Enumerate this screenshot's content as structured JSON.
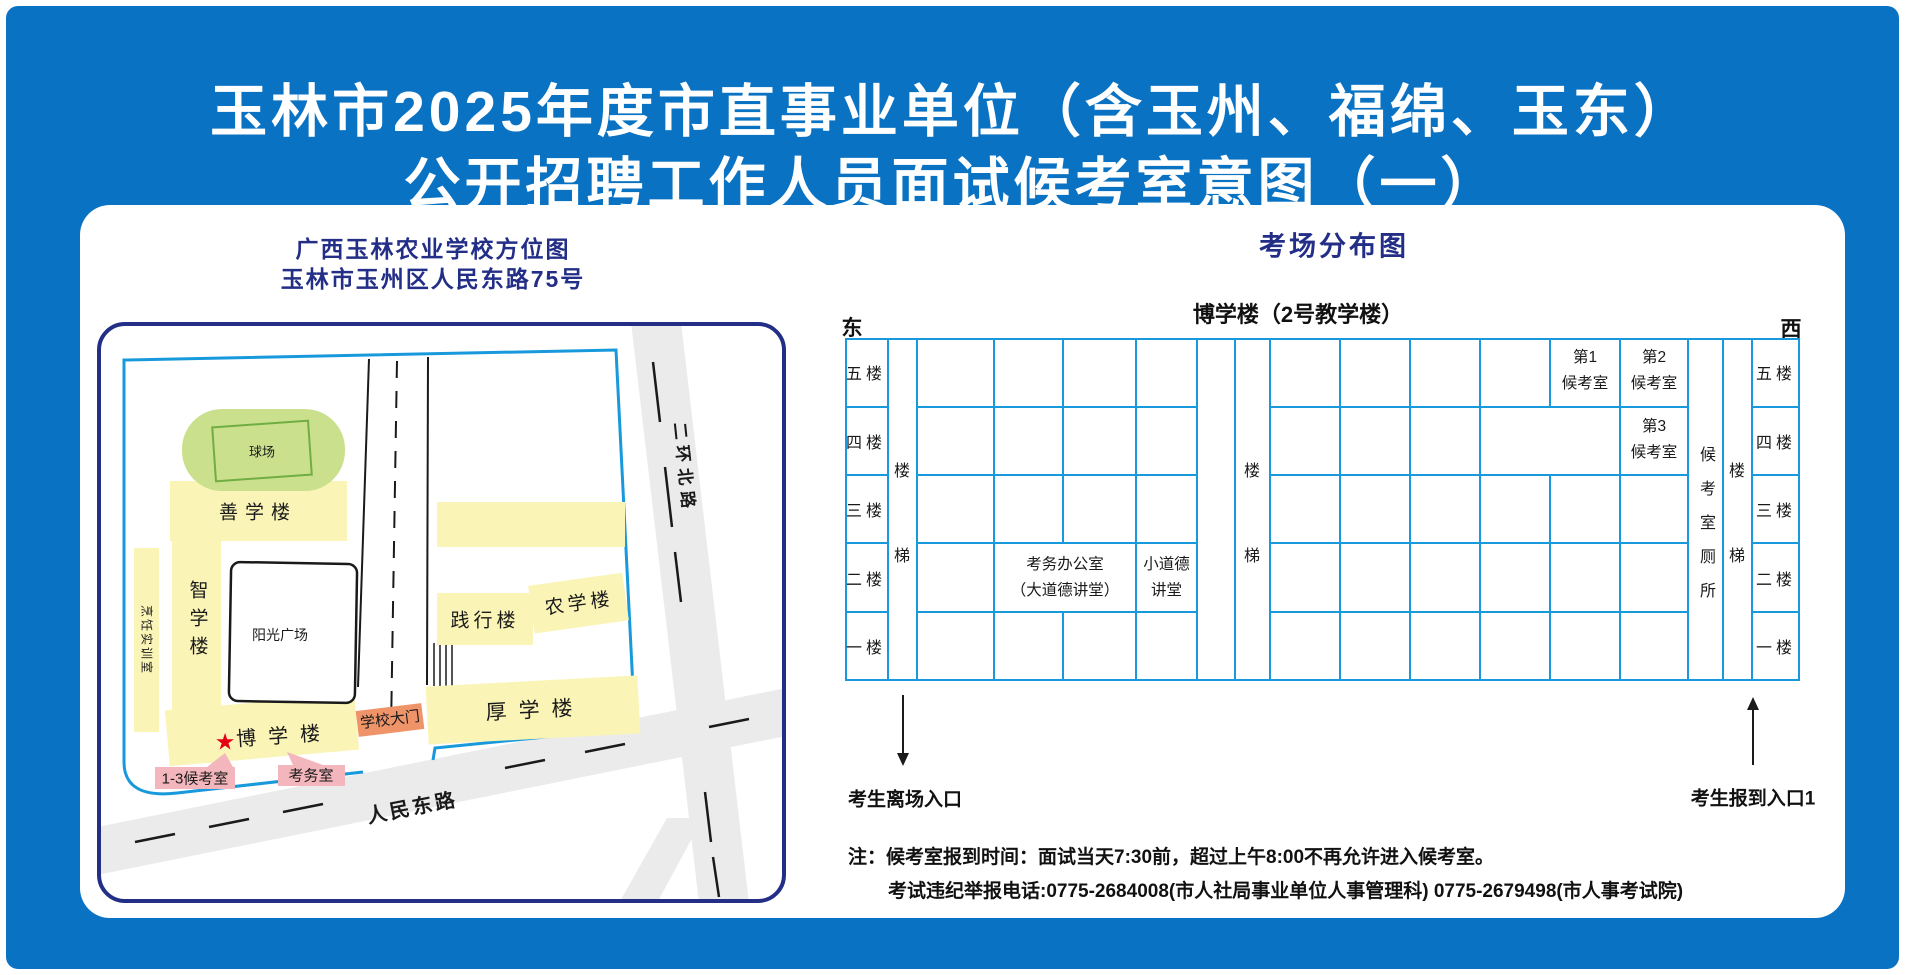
{
  "header": {
    "title_line1": "玉林市2025年度市直事业单位（含玉州、福绵、玉东）",
    "title_line2": "公开招聘工作人员面试候考室意图（一）"
  },
  "campus_map": {
    "title_line1": "广西玉林农业学校方位图",
    "title_line2": "玉林市玉州区人民东路75号",
    "ball_field": "球场",
    "shanxue_building": "善学楼",
    "zhixue_building": "智学楼",
    "cooking_training_room": "烹饪实训室",
    "sunshine_plaza": "阳光广场",
    "jianxing_building": "践行楼",
    "nongxue_building": "农学楼",
    "houxue_building": "厚学楼",
    "boxue_building": "博学楼",
    "star_marker": "★",
    "school_gate": "学校大门",
    "waiting_rooms_callout": "1-3候考室",
    "exam_office_callout": "考务室",
    "renmin_road": "人民东路",
    "erhuan_road": "二环北路"
  },
  "exam_layout": {
    "title": "考场分布图",
    "building_label": "博学楼（2号教学楼）",
    "east": "东",
    "west": "西",
    "floors": [
      "五楼",
      "四楼",
      "三楼",
      "二楼",
      "一楼"
    ],
    "stair_char_top": "楼",
    "stair_char_bottom": "梯",
    "wc_label": "候考室厕所",
    "room1_line1": "第1",
    "room1_line2": "候考室",
    "room2_line1": "第2",
    "room2_line2": "候考室",
    "room3_line1": "第3",
    "room3_line2": "候考室",
    "office_line1": "考务办公室",
    "office_line2": "（大道德讲堂）",
    "small_hall_line1": "小道德",
    "small_hall_line2": "讲堂",
    "exit_label": "考生离场入口",
    "entry_label": "考生报到入口1"
  },
  "notes": {
    "line1": "注：候考室报到时间：面试当天7:30前，超过上午8:00不再允许进入候考室。",
    "line2": "考试违纪举报电话:0775-2684008(市人社局事业单位人事管理科) 0775-2679498(市人事考试院)"
  },
  "colors": {
    "background_blue": "#0a72c3",
    "navy": "#232e87",
    "line_blue": "#1899dc",
    "building_yellow": "#faf4b6",
    "field_green": "#cbe08d",
    "field_green_stroke": "#70ad42",
    "gate_orange": "#ef9368",
    "callout_pink": "#f3b6bc",
    "star_red": "#e60013",
    "road_grey": "#ebebeb"
  }
}
